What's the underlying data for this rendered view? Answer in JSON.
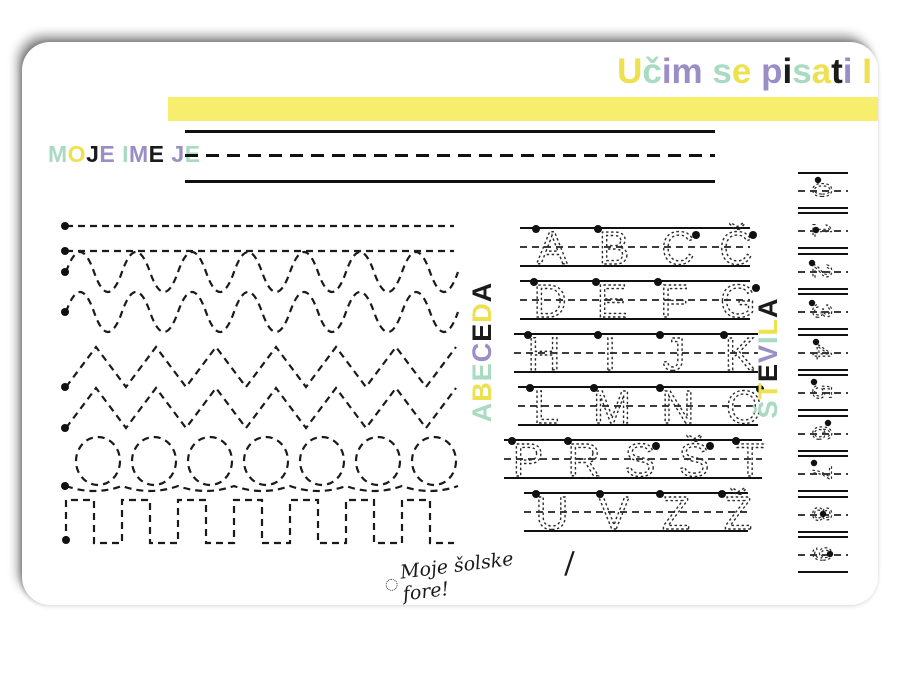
{
  "colors": {
    "bar_yellow": "#F7EE6D",
    "yellow": "#EDE14F",
    "mint": "#A9DAC2",
    "purple": "#9B8DC5",
    "black": "#1B1B1B"
  },
  "header": {
    "title_text": "Učim se pisati I",
    "title_letters": [
      {
        "ch": "U",
        "color": "#EDE14F"
      },
      {
        "ch": "č",
        "color": "#A9DAC2"
      },
      {
        "ch": "i",
        "color": "#9B8DC5"
      },
      {
        "ch": "m",
        "color": "#9B8DC5"
      },
      {
        "ch": " "
      },
      {
        "ch": "s",
        "color": "#A9DAC2"
      },
      {
        "ch": "e",
        "color": "#EDE14F"
      },
      {
        "ch": " "
      },
      {
        "ch": "p",
        "color": "#9B8DC5"
      },
      {
        "ch": "i",
        "color": "#1B1B1B"
      },
      {
        "ch": "s",
        "color": "#A9DAC2"
      },
      {
        "ch": "a",
        "color": "#EDE14F"
      },
      {
        "ch": "t",
        "color": "#1B1B1B"
      },
      {
        "ch": "i",
        "color": "#9B8DC5"
      },
      {
        "ch": " "
      },
      {
        "ch": "I",
        "color": "#EDE14F"
      }
    ]
  },
  "name_section": {
    "label_text": "MOJE IME JE",
    "label_letters": [
      {
        "ch": "M",
        "color": "#A9DAC2"
      },
      {
        "ch": "O",
        "color": "#EDE14F"
      },
      {
        "ch": "J",
        "color": "#1B1B1B"
      },
      {
        "ch": "E",
        "color": "#9B8DC5"
      },
      {
        "ch": " "
      },
      {
        "ch": "I",
        "color": "#A9DAC2"
      },
      {
        "ch": "M",
        "color": "#9B8DC5"
      },
      {
        "ch": "E",
        "color": "#1B1B1B"
      },
      {
        "ch": " "
      },
      {
        "ch": "J",
        "color": "#9B8DC5"
      },
      {
        "ch": "E",
        "color": "#A9DAC2"
      }
    ]
  },
  "tracing_patterns": {
    "rows": [
      "straight-line",
      "straight-line",
      "wave",
      "wave",
      "zigzag",
      "zigzag",
      "loops",
      "square-wave"
    ]
  },
  "alphabet": {
    "label_text": "ABECEDA",
    "label_letters": [
      {
        "ch": "A",
        "color": "#A9DAC2"
      },
      {
        "ch": "B",
        "color": "#EDE14F"
      },
      {
        "ch": "E",
        "color": "#A9DAC2"
      },
      {
        "ch": "C",
        "color": "#9B8DC5"
      },
      {
        "ch": "E",
        "color": "#1B1B1B"
      },
      {
        "ch": "D",
        "color": "#EDE14F"
      },
      {
        "ch": "A",
        "color": "#1B1B1B"
      }
    ],
    "rows": [
      {
        "letters": [
          "A",
          "B",
          "C",
          "Č"
        ]
      },
      {
        "letters": [
          "D",
          "E",
          "F",
          "G"
        ]
      },
      {
        "letters": [
          "H",
          "I",
          "J",
          "K"
        ]
      },
      {
        "letters": [
          "L",
          "M",
          "N",
          "O"
        ]
      },
      {
        "letters": [
          "P",
          "R",
          "S",
          "Š",
          "T"
        ]
      },
      {
        "letters": [
          "U",
          "V",
          "Z",
          "Ž"
        ]
      }
    ]
  },
  "numbers": {
    "label_text": "ŠTEVILA",
    "label_letters": [
      {
        "ch": "Š",
        "color": "#A9DAC2"
      },
      {
        "ch": "T",
        "color": "#EDE14F"
      },
      {
        "ch": "E",
        "color": "#1B1B1B"
      },
      {
        "ch": "V",
        "color": "#9B8DC5"
      },
      {
        "ch": "I",
        "color": "#A9DAC2"
      },
      {
        "ch": "L",
        "color": "#EDE14F"
      },
      {
        "ch": "A",
        "color": "#1B1B1B"
      }
    ],
    "digits": [
      "0",
      "1",
      "2",
      "3",
      "4",
      "5",
      "6",
      "7",
      "8",
      "9"
    ]
  },
  "logo": {
    "text": "Moje šolske fore!",
    "flourish": "/"
  }
}
